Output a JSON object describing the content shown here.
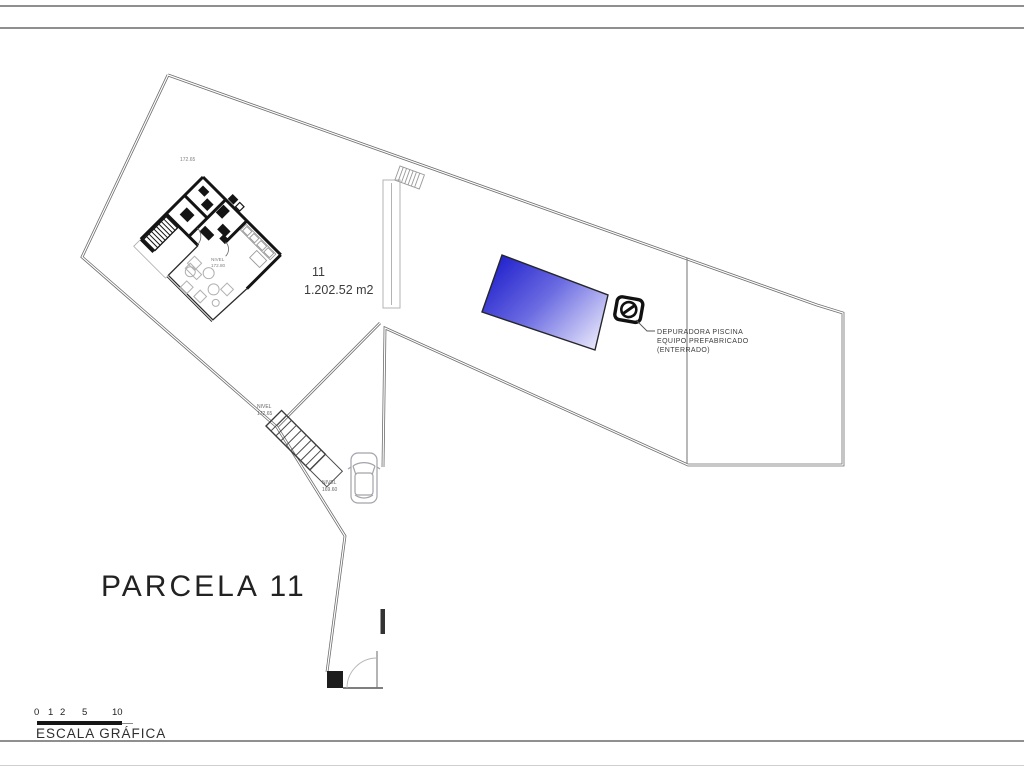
{
  "drawing": {
    "parcel_label": "PARCELA 11",
    "parcel_number": "11",
    "parcel_area": "1.202.52 m2",
    "levels": {
      "garden": "172.65",
      "house": {
        "l1": "NIVEL",
        "l2": "172.80"
      },
      "stairs": {
        "l1": "NIVEL",
        "l2": "172.65"
      },
      "driveway": {
        "l1": "NIVEL",
        "l2": "169.60"
      }
    },
    "pool_equipment_note": {
      "l1": "DEPURADORA PISCINA",
      "l2": "EQUIPO PREFABRICADO",
      "l3": "(ENTERRADO)"
    },
    "colors": {
      "pool_dark": "#2323cd",
      "pool_mid": "#6b6be2",
      "pool_light": "#efeefc",
      "boundary_line": "#6e6e6e"
    }
  },
  "scale_bar": {
    "caption": "ESCALA GRÁFICA",
    "ticks": [
      "0",
      "1",
      "2",
      "5",
      "10"
    ]
  }
}
